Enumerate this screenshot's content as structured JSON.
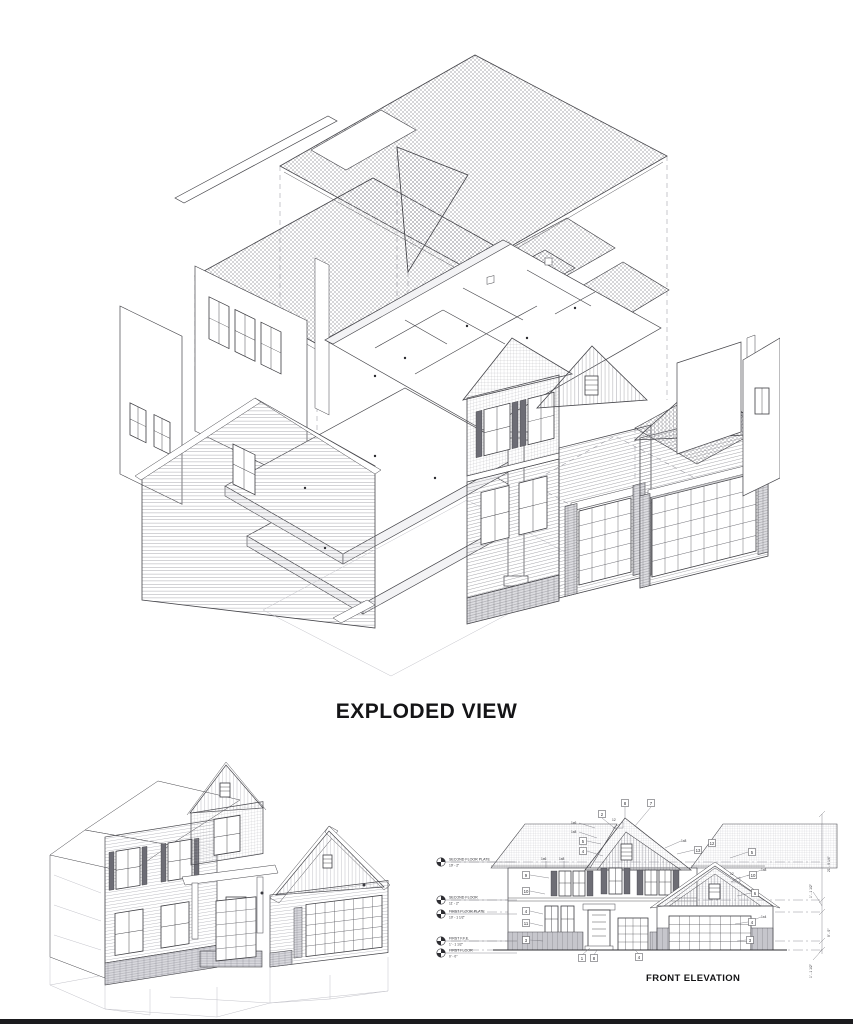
{
  "document": {
    "background": "#ffffff",
    "ink": "#45454a",
    "sheet_edge_color": "#1b1b1e"
  },
  "exploded_view": {
    "title": "EXPLODED VIEW"
  },
  "front_elevation": {
    "title": "FRONT ELEVATION",
    "levels": [
      {
        "label": "SECOND FLOOR PLATE",
        "elevation": "19' - 2\""
      },
      {
        "label": "SECOND FLOOR",
        "elevation": "11' - 2\""
      },
      {
        "label": "FIRST FLOOR PLATE",
        "elevation": "10' - 1 1/2\""
      },
      {
        "label": "FIRST F.F.E.",
        "elevation": "1' - 1 1/2\""
      },
      {
        "label": "FIRST FLOOR",
        "elevation": "0' - 0\""
      }
    ],
    "dimensions_right": [
      "21' - 0 1/4\"",
      "1' - 1 1/2\"",
      "9' - 0\"",
      "1' - 1 1/2\""
    ],
    "roof_pitch": "12",
    "callouts": {
      "top": [
        "8",
        "7"
      ],
      "upper_gable": [
        "2",
        "5",
        "4"
      ],
      "right_gable": [
        "13",
        "12"
      ],
      "left_column": [
        "9",
        "10",
        "4",
        "11",
        "3"
      ],
      "right_column": [
        "5",
        "10",
        "6",
        "4",
        "3"
      ],
      "bottom": [
        "1",
        "8",
        "4"
      ]
    },
    "trim_labels": {
      "t1x6": "1x6",
      "t1x8": "1x8",
      "t1x4": "1x4"
    }
  }
}
